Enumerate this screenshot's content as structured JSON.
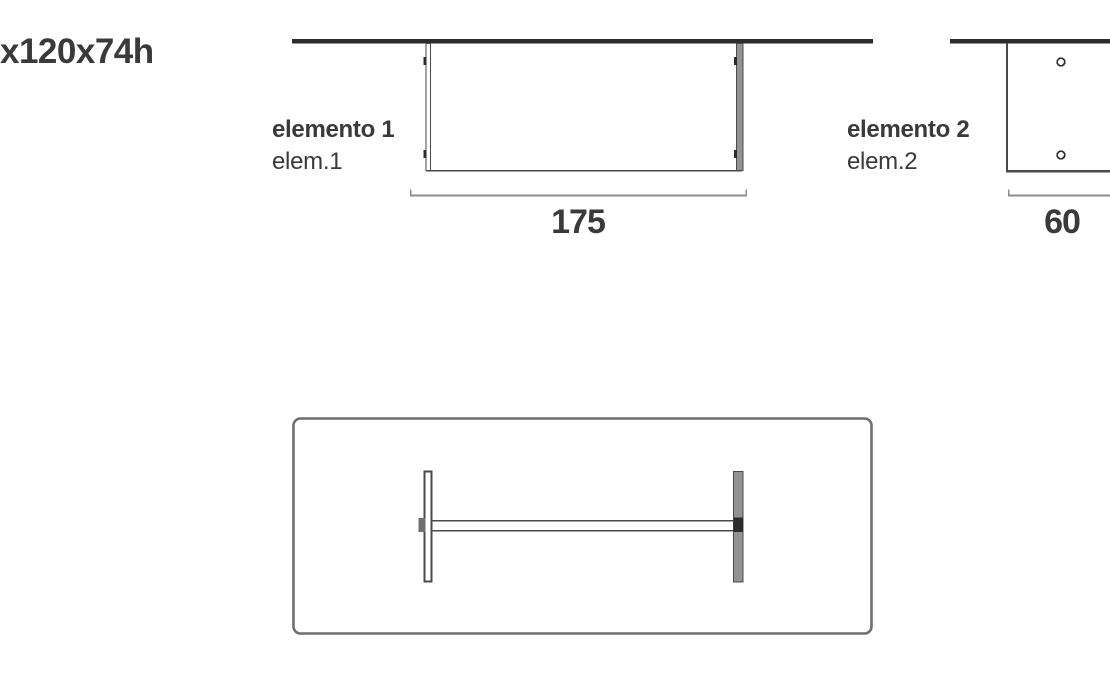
{
  "sheet": {
    "overall_dimensions": "x120x74h",
    "colors": {
      "background": "#ffffff",
      "text": "#3a3a3a",
      "line_dark": "#2c2c2c",
      "line_medium": "#4a4a4a",
      "line_light": "#8e8e8e",
      "line_plan": "#6f6f6f",
      "panel_gray": "#929292"
    }
  },
  "element1": {
    "name": "elemento 1",
    "short_name": "elem.1",
    "width_dimension": "175"
  },
  "element2": {
    "name": "elemento 2",
    "short_name": "elem.2",
    "width_dimension": "60"
  }
}
